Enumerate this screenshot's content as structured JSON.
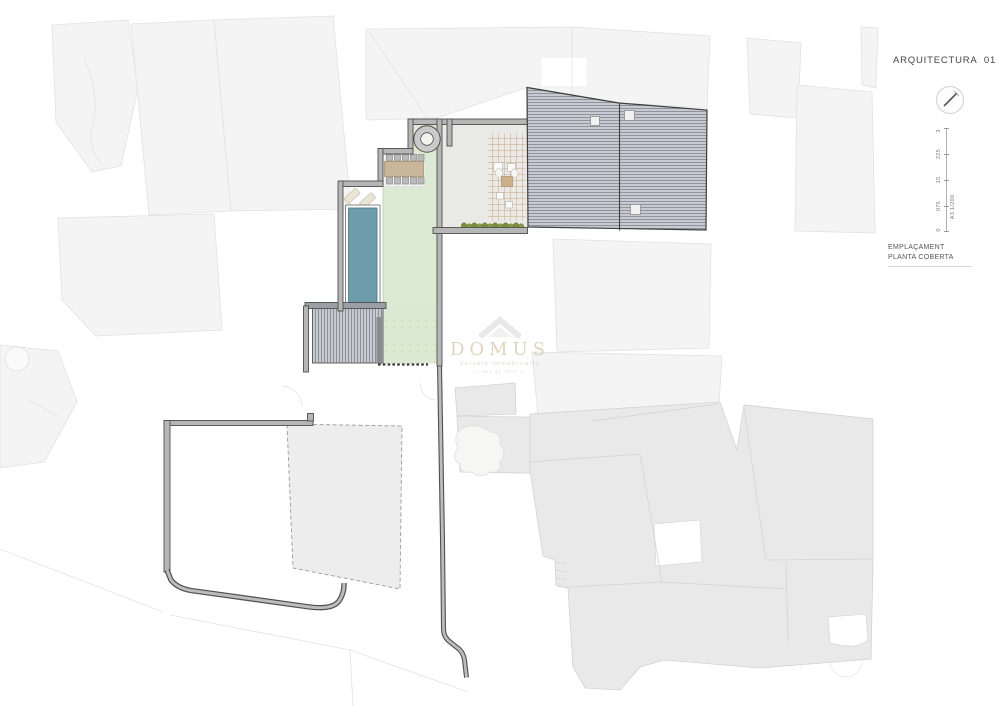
{
  "titleblock": {
    "title": "ARQUITECTURA  01",
    "drawing_label_line1": "EMPLAÇAMENT",
    "drawing_label_line2": "PLANTA COBERTA",
    "scale_bar": {
      "tick_labels_top_to_bottom": [
        "3",
        "225",
        "15",
        "075",
        "0"
      ],
      "sheet_scale": "A3  1/200"
    }
  },
  "watermark": {
    "brand": "DOMUS",
    "tagline": "Serveis immobiliaris",
    "subline": "— des de 1973 —"
  },
  "icons": {
    "north_arrow_icon": "circle-with-needle",
    "domus_house_icon": "roof-outline"
  },
  "colors": {
    "lawn_green": "#dcead3",
    "pool_teal": "#6d9dab",
    "roof_gray": "#c7cad0",
    "wall_gray": "#b6b6b6",
    "neighbor_parcel": "#f4f4f5",
    "lower_parcel": "#e9e9ea",
    "watermark_gold": "#c5b288"
  }
}
